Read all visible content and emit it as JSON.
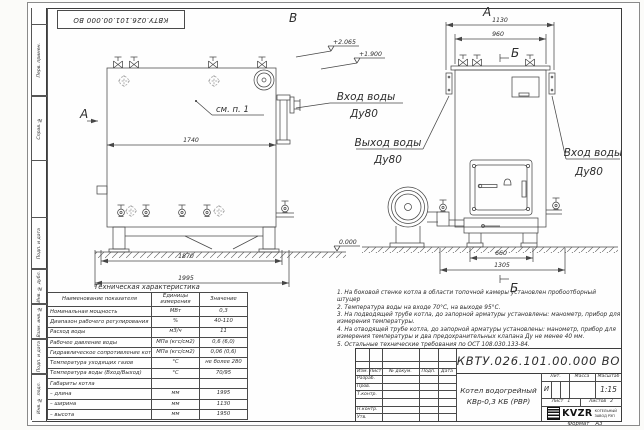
{
  "stamp": {
    "doc_number": "КВТУ.026.101.00.000  ВО"
  },
  "frame_labels": {
    "perv_primen": "Перв. примен.",
    "sprav_no": "Справ. №",
    "podp_data_1": "Подп. и дата",
    "inv_dubl": "Инв. № дубл.",
    "vzam_inv": "Взам. инв. №",
    "podp_data_2": "Подп. и дата",
    "inv_podl": "Инв. № подл."
  },
  "side_view": {
    "view_label": "В",
    "arrow_label": "А",
    "callout": "см. п. 1",
    "dim_inner": "1740",
    "dim_base": "1870",
    "dim_overall": "1995",
    "elev_top": "+2.065",
    "elev_mid": "+1.900",
    "elev_zero": "0.000",
    "inlet_line1": "Вход воды",
    "inlet_line2": "Ду80"
  },
  "front_view": {
    "view_label": "А",
    "section_top": "Б",
    "section_bottom": "Б",
    "dim_overall": "1130",
    "dim_inner": "960",
    "dim_bottom_inner": "660",
    "dim_bottom_overall": "1305",
    "outlet_line1": "Выход воды",
    "outlet_line2": "Ду80",
    "inlet_line1": "Вход воды",
    "inlet_line2": "Ду80"
  },
  "notes": {
    "items": [
      "1.  На боковой стенке котла в области топочной камеры установлен пробоотборный штуцер",
      "2.  Температура воды на входе 70°С, на выходе 95°С.",
      "3.  На подводящей трубе котла, до запорной арматуры установлены: манометр, прибор для измерения температуры.",
      "4.  На отводящей трубе котла, до запорной арматуры установлены: манометр, прибор для измерения температуры и два предохранительных клапана Ду не менее 40 мм.",
      "5.  Остальные технические требования по ОСТ 108.030.133-84."
    ]
  },
  "spec_table": {
    "title": "Техническая характеристика",
    "headers": [
      "Наименование показателя",
      "Единицы измерения",
      "Значение"
    ],
    "rows": [
      [
        "Номинальная мощность",
        "МВт",
        "0,3"
      ],
      [
        "Диапазон рабочего регулирования",
        "%",
        "40-110"
      ],
      [
        "Расход воды",
        "м3/ч",
        "11"
      ],
      [
        "Рабочее давление воды",
        "МПа (кгс/см2)",
        "0,6 (6,0)"
      ],
      [
        "Гидравлическое сопротивление котла",
        "МПа (кгс/см2)",
        "0,06 (0,6)"
      ],
      [
        "Температура уходящих газов",
        "°С",
        "не более 280"
      ],
      [
        "Температура воды (Вход/Выход)",
        "°С",
        "70/95"
      ],
      [
        "Габариты котла",
        "",
        ""
      ],
      [
        "  – длина",
        "мм",
        "1995"
      ],
      [
        "  – ширина",
        "мм",
        "1130"
      ],
      [
        "  – высота",
        "мм",
        "1950"
      ]
    ]
  },
  "title_block": {
    "doc_number": "КВТУ.026.101.00.000  ВО",
    "product_line1": "Котел водогрейный",
    "product_line2": "КВр-0,3  КБ  (РВР)",
    "col_izm": "Изм.",
    "col_list": "Лист",
    "col_docnum": "№ докум.",
    "col_podp": "Подп.",
    "col_data": "Дата",
    "row_razrab": "Разраб.",
    "row_prov": "Пров.",
    "row_tkontr": "Т.контр.",
    "row_nkontr": "Н.контр.",
    "row_utv": "Утв.",
    "lit_label": "Лит.",
    "lit_value": "И",
    "mass_label": "Масса",
    "scale_label": "Масштаб",
    "scale_value": "1:15",
    "sheet_label": "Лист",
    "sheet_value": "1",
    "sheets_label": "Листов",
    "sheets_value": "2",
    "logo_text": "KVZR",
    "company_line1": "КОТЕЛЬНЫЙ",
    "company_line2": "ЗАВОД РЭП"
  },
  "format_note": {
    "label": "Формат",
    "value": "А3"
  }
}
